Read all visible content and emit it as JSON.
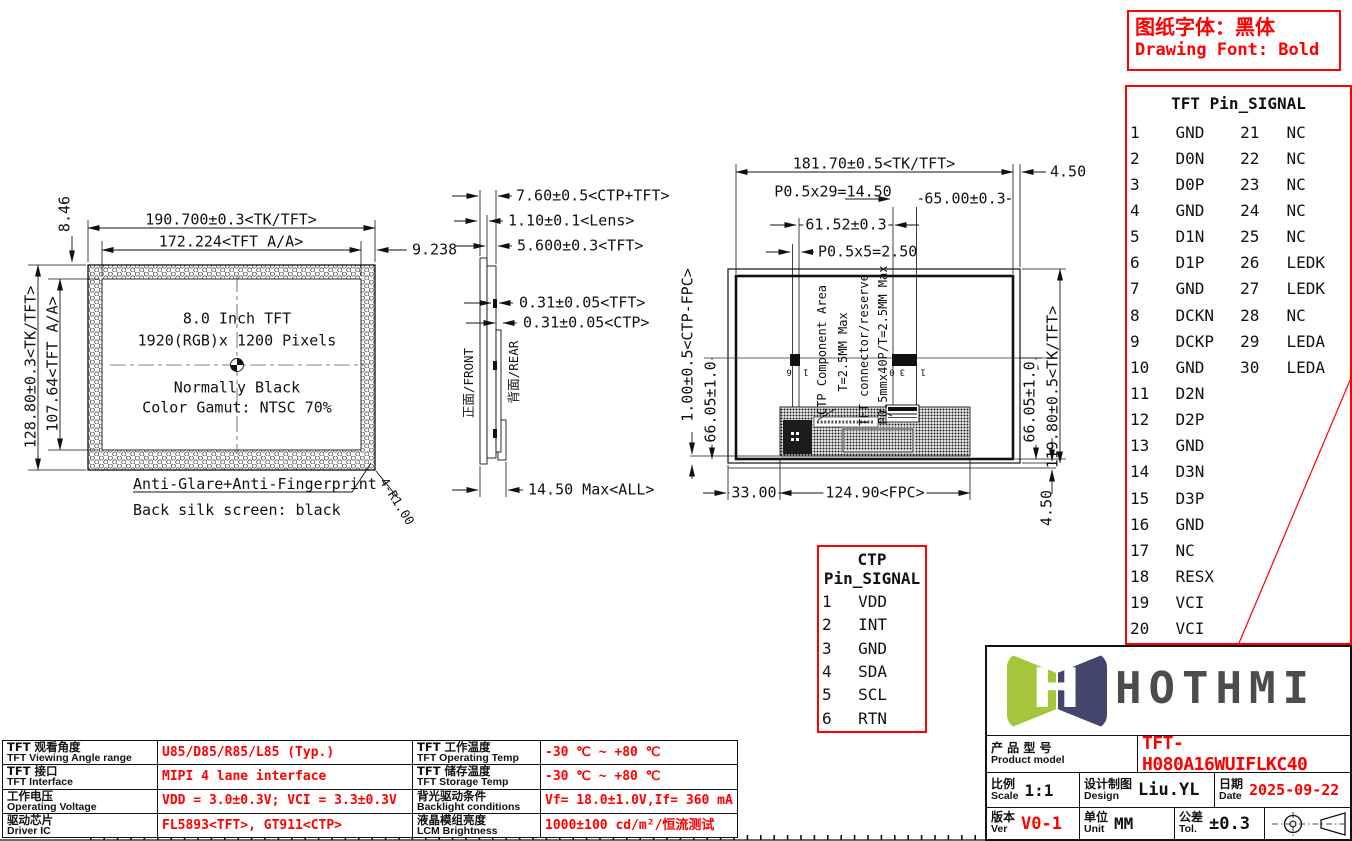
{
  "colors": {
    "red": "#ff0000",
    "ink": "#111111",
    "logo_green": "#a5c63b",
    "logo_navy": "#45466e",
    "logo_text": "#4c4c4c"
  },
  "notice": {
    "cn": "图纸字体：黑体",
    "en": "Drawing Font: Bold"
  },
  "tft_pin_table": {
    "title": "TFT Pin_SIGNAL",
    "rows": [
      [
        "1",
        "GND",
        "21",
        "NC"
      ],
      [
        "2",
        "D0N",
        "22",
        "NC"
      ],
      [
        "3",
        "D0P",
        "23",
        "NC"
      ],
      [
        "4",
        "GND",
        "24",
        "NC"
      ],
      [
        "5",
        "D1N",
        "25",
        "NC"
      ],
      [
        "6",
        "D1P",
        "26",
        "LEDK"
      ],
      [
        "7",
        "GND",
        "27",
        "LEDK"
      ],
      [
        "8",
        "DCKN",
        "28",
        "NC"
      ],
      [
        "9",
        "DCKP",
        "29",
        "LEDA"
      ],
      [
        "10",
        "GND",
        "30",
        "LEDA"
      ],
      [
        "11",
        "D2N",
        "",
        ""
      ],
      [
        "12",
        "D2P",
        "",
        ""
      ],
      [
        "13",
        "GND",
        "",
        ""
      ],
      [
        "14",
        "D3N",
        "",
        ""
      ],
      [
        "15",
        "D3P",
        "",
        ""
      ],
      [
        "16",
        "GND",
        "",
        ""
      ],
      [
        "17",
        "NC",
        "",
        ""
      ],
      [
        "18",
        "RESX",
        "",
        ""
      ],
      [
        "19",
        "VCI",
        "",
        ""
      ],
      [
        "20",
        "VCI",
        "",
        ""
      ]
    ]
  },
  "ctp_pin_table": {
    "title": "CTP Pin_SIGNAL",
    "rows": [
      [
        "1",
        "VDD"
      ],
      [
        "2",
        "INT"
      ],
      [
        "3",
        "GND"
      ],
      [
        "4",
        "SDA"
      ],
      [
        "5",
        "SCL"
      ],
      [
        "6",
        "RTN"
      ]
    ]
  },
  "spec_table": {
    "rows": [
      {
        "label_cn": "TFT 观看角度",
        "label_en": "TFT Viewing Angle range",
        "value": "U85/D85/R85/L85 (Typ.)",
        "label2_cn": "TFT 工作温度",
        "label2_en": "TFT Operating Temp",
        "value2": "-30 ℃ ~ +80 ℃"
      },
      {
        "label_cn": "TFT 接口",
        "label_en": "TFT Interface",
        "value": "MIPI 4 lane interface",
        "label2_cn": "TFT 储存温度",
        "label2_en": "TFT Storage Temp",
        "value2": "-30 ℃ ~ +80 ℃"
      },
      {
        "label_cn": "工作电压",
        "label_en": "Operating Voltage",
        "value": "VDD = 3.0±0.3V; VCI = 3.3±0.3V",
        "label2_cn": "背光驱动条件",
        "label2_en": "Backlight conditions",
        "value2": "Vf= 18.0±1.0V,If= 360 mA"
      },
      {
        "label_cn": "驱动芯片",
        "label_en": "Driver IC",
        "value": "FL5893<TFT>, GT911<CTP>",
        "label2_cn": "液晶模组亮度",
        "label2_en": "LCM Brightness",
        "value2": "1000±100 cd/m²/恒流测试"
      }
    ]
  },
  "front": {
    "dim_width_outer": "190.700±0.3<TK/TFT>",
    "dim_width_aa": "172.224<TFT A/A>",
    "dim_right_margin": "9.238",
    "dim_top_margin": "8.46",
    "dim_height_outer": "128.80±0.3<TK/TFT>",
    "dim_height_aa": "107.64<TFT A/A>",
    "line1": "8.0 Inch TFT",
    "line2": "1920(RGB)x 1200 Pixels",
    "line3": "Normally Black",
    "line4": "Color Gamut: NTSC 70%",
    "note1": "Anti-Glare+Anti-Fingerprint",
    "note2": "Back silk screen: black",
    "corner_radius": "4-R1.00"
  },
  "side": {
    "dim_total": "7.60±0.5<CTP+TFT>",
    "dim_lens": "1.10±0.1<Lens>",
    "dim_tft": "5.600±0.3<TFT>",
    "dim_pol_tft": "0.31±0.05<TFT>",
    "dim_pol_ctp": "0.31±0.05<CTP>",
    "front_label": "正面/FRONT",
    "rear_label": "背面/REAR",
    "dim_max": "14.50 Max<ALL>"
  },
  "rear": {
    "dim_width": "181.70±0.5<TK/TFT>",
    "dim_side_top": "4.50",
    "dim_pitch29": "P0.5x29=14.50",
    "dim_65": "65.00±0.3",
    "dim_6152": "61.52±0.3",
    "dim_pitch5": "P0.5x5=2.50",
    "dim_ctpfpc": "1.00±0.5<CTP-FPC>",
    "dim_6605_left": "66.05±1.0",
    "dim_6605_right": "66.05±1.0",
    "dim_height": "119.80±0.5<TK/TFT>",
    "dim_450_bottom": "4.50",
    "label_ctp_area": "CTP Component Area",
    "label_ctp_t": "T=2.5MM Max",
    "label_tft_conn": "TFT connector/reserve",
    "label_tft_t": "P0.5mmx40P/T=2.5MM Max",
    "dim_33": "33.00",
    "dim_fpc": "124.90<FPC>",
    "pins_small": "1 6",
    "pins_big": "1 30"
  },
  "title_block": {
    "logo_text": "HOTHMI",
    "product_cn": "产 品 型 号",
    "product_en": "Product model",
    "product_value": "TFT-H080A16WUIFLKC40",
    "scale_cn": "比例",
    "scale_en": "Scale",
    "scale_value": "1:1",
    "design_cn": "设计制图",
    "design_en": "Design",
    "design_value": "Liu.YL",
    "date_cn": "日期",
    "date_en": "Date",
    "date_value": "2025-09-22",
    "ver_cn": "版本",
    "ver_en": "Ver",
    "ver_value": "V0-1",
    "unit_cn": "单位",
    "unit_en": "Unit",
    "unit_value": "MM",
    "tol_cn": "公差",
    "tol_en": "Tol.",
    "tol_value": "±0.3"
  }
}
